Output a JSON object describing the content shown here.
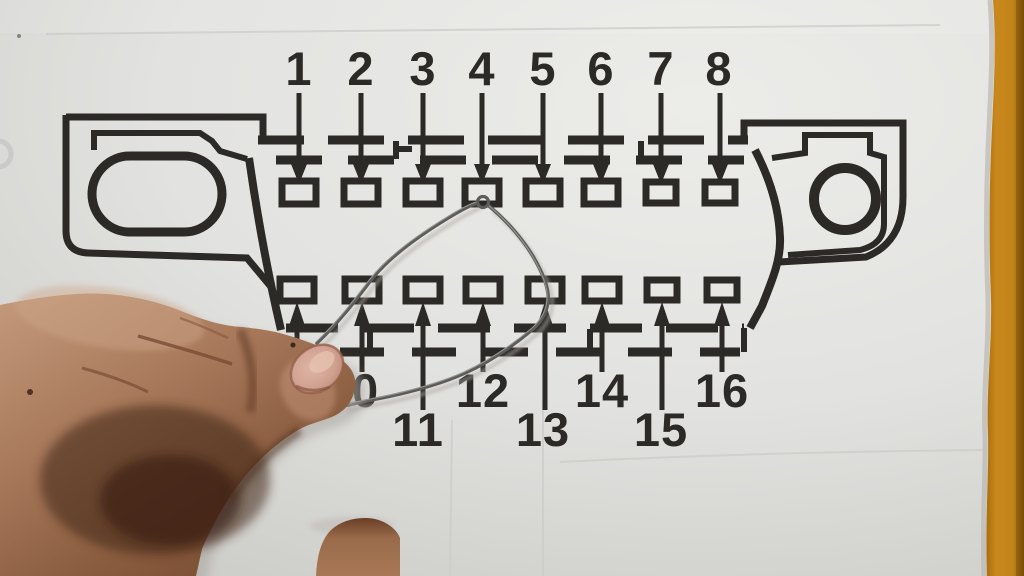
{
  "diagram": {
    "connector": {
      "top_pin_labels": [
        "1",
        "2",
        "3",
        "4",
        "5",
        "6",
        "7",
        "8"
      ],
      "bottom_pin_labels": [
        "10",
        "11",
        "12",
        "13",
        "14",
        "15",
        "16"
      ]
    }
  },
  "colors": {
    "ink": "#2b2a27",
    "paper": "#e3e3e1",
    "paper_shadow": "#aea9a2",
    "desk": "#c2831a",
    "desk_dark": "#8f5c08",
    "wire": "#5c5c5a",
    "skin": "#a97a5c",
    "skin_shadow": "#45291c",
    "nail": "#cfa090"
  }
}
